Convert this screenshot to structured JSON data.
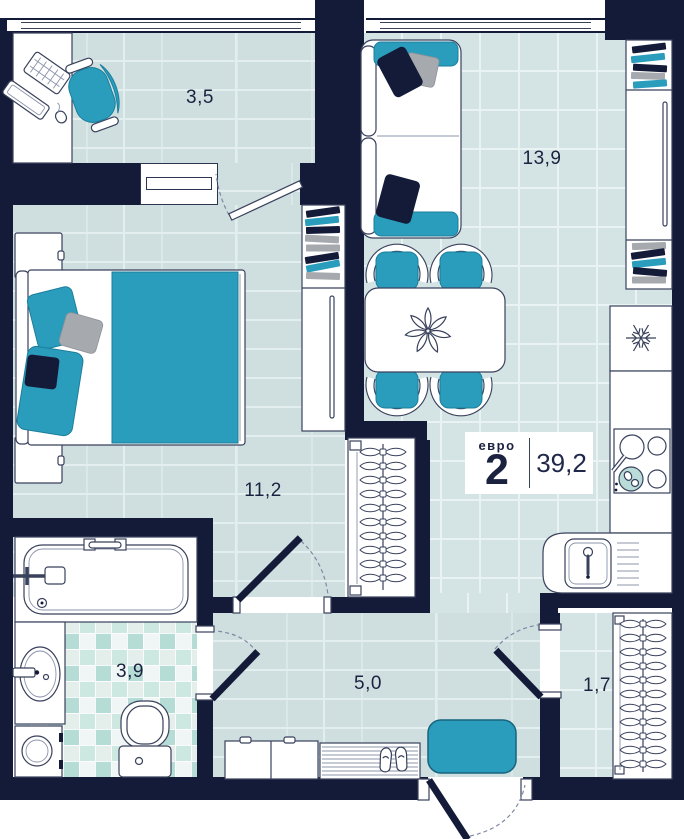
{
  "floor_plan": {
    "badge": {
      "type_label": "евро",
      "rooms_count": "2",
      "total_area": "39,2"
    },
    "rooms": [
      {
        "key": "loggia",
        "area_label": "3,5"
      },
      {
        "key": "living-kitchen",
        "area_label": "13,9"
      },
      {
        "key": "bedroom",
        "area_label": "11,2"
      },
      {
        "key": "bathroom",
        "area_label": "3,9"
      },
      {
        "key": "hallway",
        "area_label": "5,0"
      },
      {
        "key": "balcony",
        "area_label": "1,7"
      }
    ],
    "icons": [
      {
        "name": "snowflake-icon",
        "meaning": "refrigerator"
      }
    ],
    "colors": {
      "wall": "#141b38",
      "accent": "#2a9dbd",
      "floor_plank": "#cfdfe0",
      "floor_tile": "#d4e3e3",
      "grout": "#e9f3f3",
      "gray": "#a6a9ad",
      "outline": "#39415c",
      "label_text": "#1b2240",
      "mosaic_teal": "#b5ddd6",
      "background": "#ffffff"
    }
  }
}
